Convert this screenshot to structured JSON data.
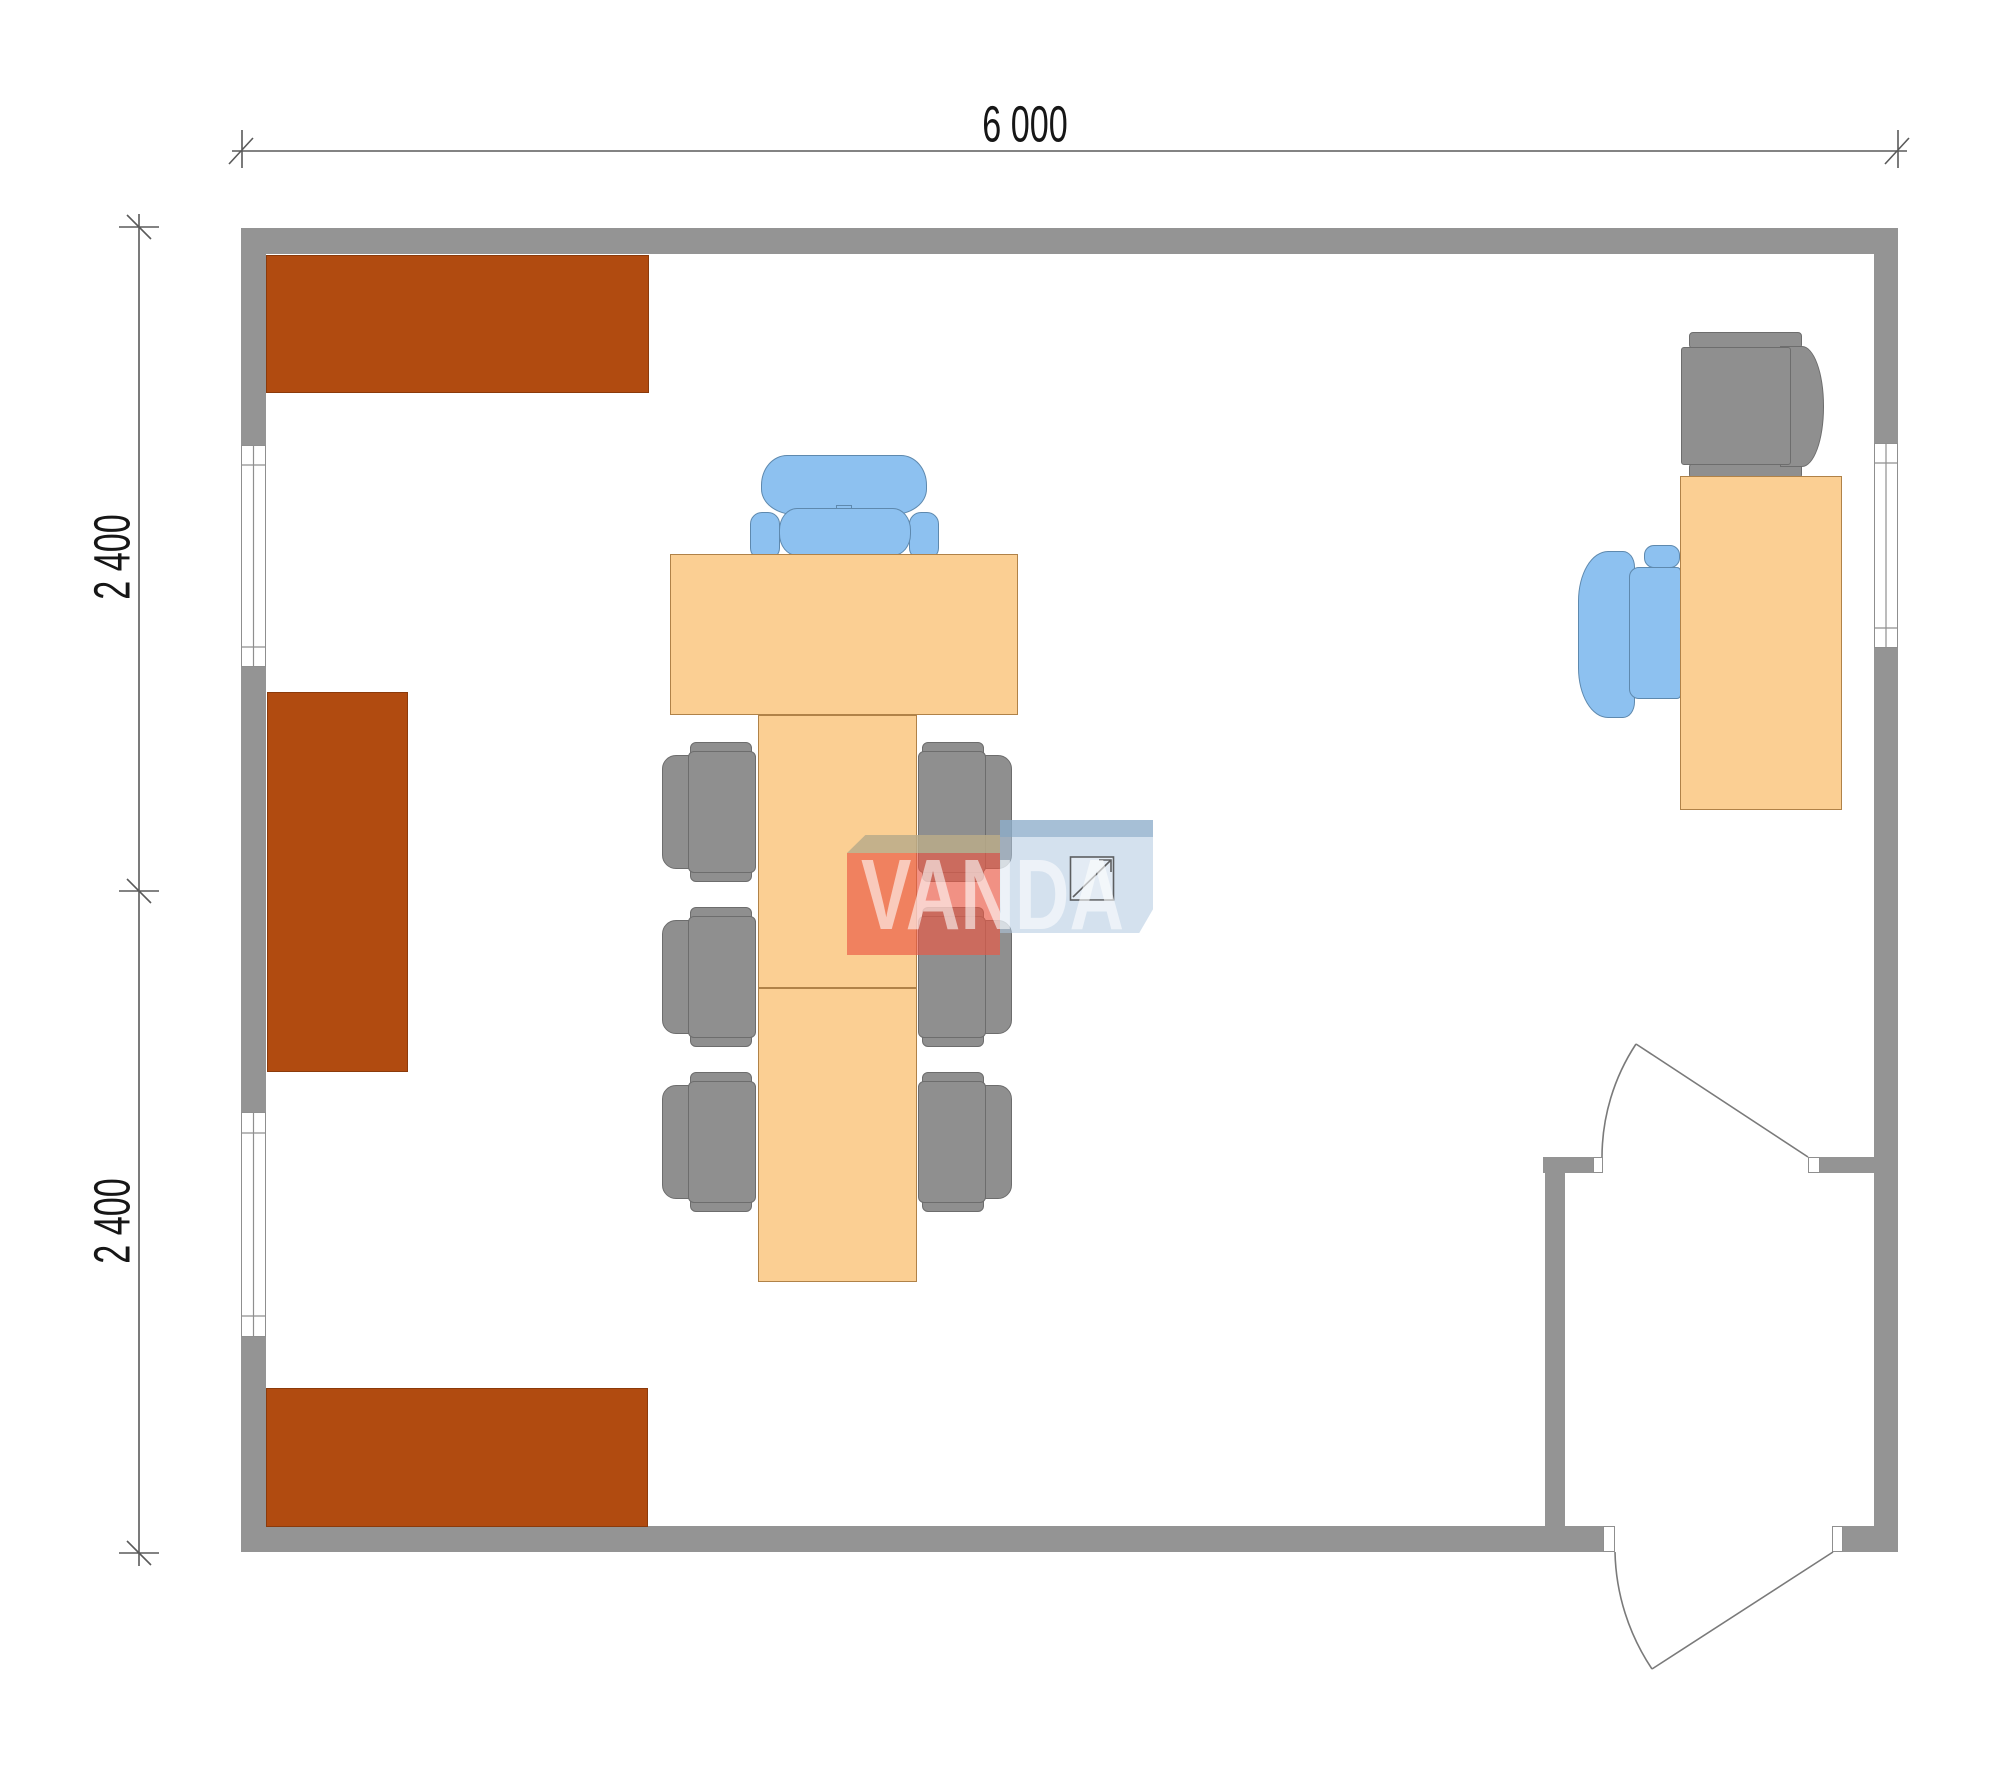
{
  "page": {
    "type": "architectural-floor-plan",
    "background": "#ffffff",
    "width_px": 2000,
    "height_px": 1773
  },
  "dimensions": {
    "top": {
      "label": "6 000",
      "orientation": "horizontal"
    },
    "left_upper": {
      "label": "2 400",
      "orientation": "vertical"
    },
    "left_lower": {
      "label": "2 400",
      "orientation": "vertical"
    }
  },
  "watermark": {
    "brand": "VANDA",
    "mark": "square-diagonal-logo-icon"
  },
  "room": {
    "outer_walls": [
      "top",
      "bottom",
      "left",
      "right"
    ],
    "windows": [
      {
        "wall": "left",
        "position": "upper"
      },
      {
        "wall": "left",
        "position": "lower"
      },
      {
        "wall": "right",
        "position": "upper"
      }
    ],
    "doors": [
      {
        "name": "exterior-door",
        "wall": "bottom-right",
        "swing": "outward"
      },
      {
        "name": "vestibule-door",
        "wall": "interior-partition",
        "swing": "inward"
      }
    ],
    "interior_partition": "vestibule-bottom-right"
  },
  "furniture": {
    "cabinets": [
      "cabinet-top-left",
      "cabinet-middle-left",
      "cabinet-bottom-left"
    ],
    "tables": [
      "executive-desk-center",
      "conference-table-upper",
      "conference-table-lower",
      "desk-right"
    ],
    "chairs": [
      "executive-chair-blue-center",
      "meeting-chair-gray-left-1",
      "meeting-chair-gray-left-2",
      "meeting-chair-gray-left-3",
      "meeting-chair-gray-right-1",
      "meeting-chair-gray-right-2",
      "meeting-chair-gray-right-3",
      "office-chair-blue-right",
      "armchair-gray-top-right"
    ]
  },
  "colors": {
    "wall": "#949494",
    "cabinet": "#B14B10",
    "tableFill": "#FBCF93",
    "tableBorder": "#B08248",
    "chairGray": "#8F8F8F",
    "chairGrayBorder": "#6D6D6D",
    "chairBlue": "#8DC1F0",
    "chairBlueBorder": "#5E89AE",
    "windowFrame": "#8F8F8F",
    "dimLine": "#5A5A5A",
    "dimText": "#161616",
    "doorLine": "#7A7A7A",
    "wmRed": "rgba(234,88,68,0.66)",
    "wmBeige": "rgba(186,172,138,0.85)",
    "wmBlue": "rgba(176,200,224,0.55)",
    "wmBlueStrip": "rgba(128,164,194,0.55)",
    "wmText": "rgba(255,255,255,0.58)",
    "glyphStroke": "rgba(60,60,60,0.8)"
  }
}
